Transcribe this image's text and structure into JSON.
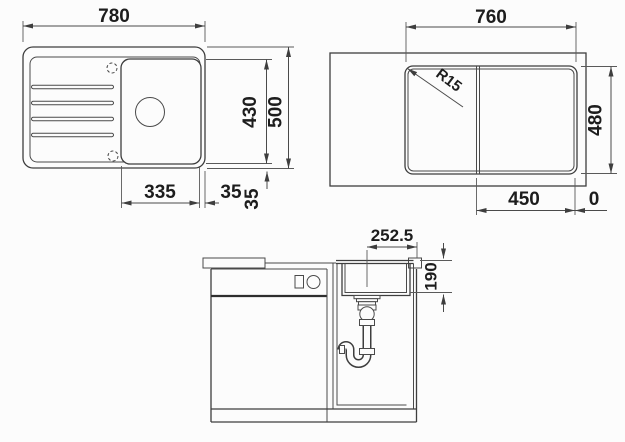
{
  "document": {
    "type": "technical-drawing",
    "subject": "inset kitchen sink with drainboard - installation dimensions"
  },
  "colors": {
    "background": "#fcfcfc",
    "line": "#3e3e3e",
    "dimension_line": "#4a4a4a",
    "text": "#1d1d1d"
  },
  "plan_view": {
    "dim_width": "780",
    "dim_height": "500",
    "dim_inner_height": "430",
    "dim_bowl_width": "335",
    "dim_gap_right": "35",
    "dim_gap_bottom": "35"
  },
  "cutout_view": {
    "dim_width": "760",
    "dim_height": "480",
    "dim_corner_radius": "R15",
    "dim_bowl_position": "450",
    "dim_zero": "0"
  },
  "front_view": {
    "dim_drain_offset": "252.5",
    "dim_bowl_depth": "190"
  }
}
